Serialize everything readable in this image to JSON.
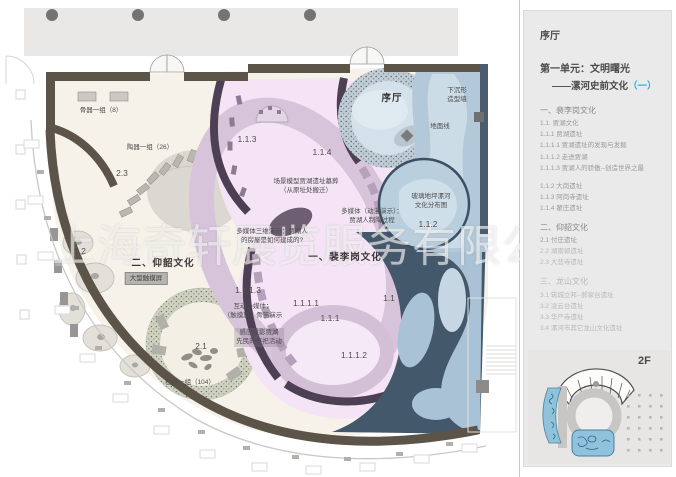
{
  "watermark": "上海奇轩展览服务有限公司",
  "sidebar": {
    "hall_title": "序厅",
    "unit_title": "第一单元：文明曙光",
    "unit_subtitle": "——漯河史前文化",
    "unit_subtitle_mark": "（一）",
    "floor_label": "2F",
    "outline": [
      {
        "t": "一、裴李岗文化",
        "cls": "hdr"
      },
      {
        "t": "1.1. 贾湖文化"
      },
      {
        "t": "1.1.1 贾湖遗址"
      },
      {
        "t": "1.1.1.1 贾湖遗址的发现与发掘"
      },
      {
        "t": "1.1.1.2 走进贾湖"
      },
      {
        "t": "1.1.1.3 贾湖人的骄傲--创造世界之最"
      },
      {
        "t": "",
        "cls": "gap"
      },
      {
        "t": "1.1.2 大岗遗址"
      },
      {
        "t": "1.1.3 阿岗寺遗址"
      },
      {
        "t": "1.1.4 翟庄遗址"
      },
      {
        "t": "",
        "cls": "gap"
      },
      {
        "t": "二、仰韶文化",
        "cls": "hdr"
      },
      {
        "t": "2.1 付庄遗址"
      },
      {
        "t": "2.2 湖南郭遗址",
        "cls": "faint"
      },
      {
        "t": "2.3 大悲寺遗址",
        "cls": "faint"
      },
      {
        "t": "",
        "cls": "gap"
      },
      {
        "t": "三、龙山文化",
        "cls": "hdr faint"
      },
      {
        "t": "3.1 筑城立邦--郝家台遗址",
        "cls": "faint"
      },
      {
        "t": "3.2 凌云台遗址",
        "cls": "faint"
      },
      {
        "t": "3.3 华严寺遗址",
        "cls": "faint"
      },
      {
        "t": "3.4 漯河市其它龙山文化遗址",
        "cls": "faint"
      }
    ]
  },
  "plan": {
    "labels": [
      {
        "t": "骨器一组（8）",
        "x": 101,
        "y": 106
      },
      {
        "t": "陶器一组（26）",
        "x": 150,
        "y": 143
      },
      {
        "t": "2.3",
        "x": 122,
        "y": 167,
        "cls": "num"
      },
      {
        "t": "2.2",
        "x": 80,
        "y": 245,
        "cls": "num"
      },
      {
        "t": "二、仰韶文化",
        "x": 163,
        "y": 257,
        "cls": "sect"
      },
      {
        "t": "大型触摸屏",
        "x": 146,
        "y": 272,
        "cls": "chip"
      },
      {
        "t": "2.1",
        "x": 201,
        "y": 340,
        "cls": "num"
      },
      {
        "t": "石器一组（104）",
        "x": 190,
        "y": 378
      },
      {
        "t": "1.1.3",
        "x": 247,
        "y": 133,
        "cls": "num"
      },
      {
        "t": "1.1.4",
        "x": 322,
        "y": 146,
        "cls": "num"
      },
      {
        "t": "场景模型贾湖遗址墓葬\n（从原址处搬迁）",
        "x": 306,
        "y": 177
      },
      {
        "t": "多媒体（动漫演示）：\n贾湖人制陶过程",
        "x": 372,
        "y": 207
      },
      {
        "t": "1.1.2",
        "x": 428,
        "y": 218,
        "cls": "num"
      },
      {
        "t": "多媒体三维演示：贾湖人\n的房屋是如何建成的?",
        "x": 272,
        "y": 227
      },
      {
        "t": "一、裴李岗文化",
        "x": 345,
        "y": 251,
        "cls": "sect"
      },
      {
        "t": "1.1.1.3",
        "x": 248,
        "y": 284,
        "cls": "num"
      },
      {
        "t": "互动多媒体：\n（触摸屏）骨笛演示",
        "x": 253,
        "y": 302
      },
      {
        "t": "1.1.1.1",
        "x": 306,
        "y": 297,
        "cls": "num"
      },
      {
        "t": "1.1.1",
        "x": 330,
        "y": 312,
        "cls": "num"
      },
      {
        "t": "感应投影贾湖\n先民的祭祀活动",
        "x": 259,
        "y": 328,
        "cls": "chip2"
      },
      {
        "t": "1.1.1.2",
        "x": 354,
        "y": 349,
        "cls": "num"
      },
      {
        "t": "1.1",
        "x": 389,
        "y": 292,
        "cls": "num"
      },
      {
        "t": "序厅",
        "x": 392,
        "y": 92,
        "cls": "sect"
      },
      {
        "t": "下沉形\n造型墙",
        "x": 457,
        "y": 86
      },
      {
        "t": "地面线",
        "x": 440,
        "y": 122
      },
      {
        "t": "玻璃地坪漯河\n文化分布图",
        "x": 431,
        "y": 192
      }
    ]
  },
  "colors": {
    "accent_blue": "#29abe2",
    "pink_zone": "#f4e4f5",
    "blue_zone": "#b3c9da",
    "slate_zone": "#44586b",
    "dark_wall": "#5c5349",
    "purple_wall": "#4d3f54",
    "minimap_blue": "#8fc3dc"
  }
}
